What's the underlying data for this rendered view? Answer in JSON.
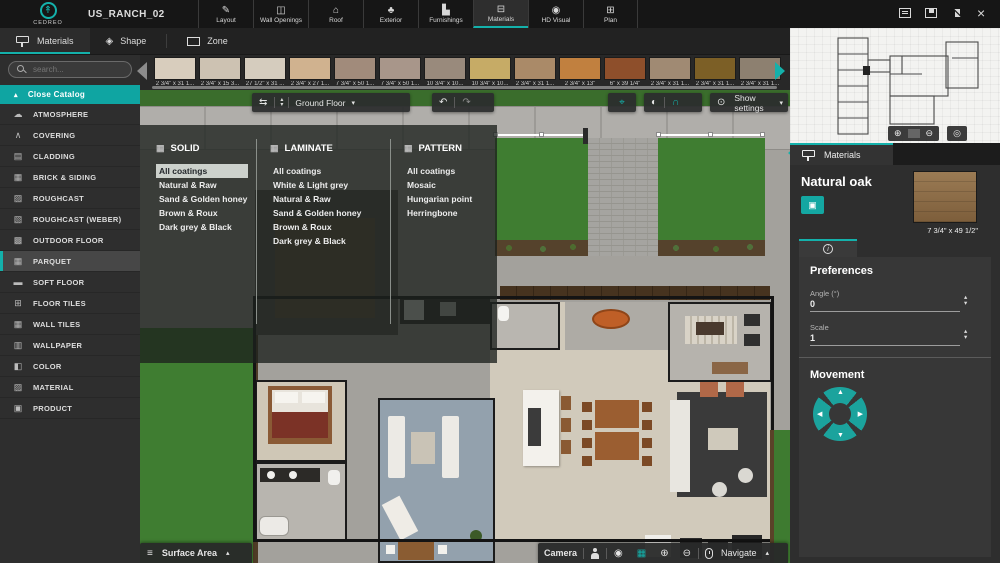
{
  "colors": {
    "accent": "#14b1ab",
    "teal_button": "#0fa5a2",
    "canvas_grass": "#3f7d31",
    "canvas_concrete": "#a3a19c"
  },
  "app": {
    "brand": "CEDREO",
    "project_title": "US_RANCH_02"
  },
  "window_controls": {
    "close": "×"
  },
  "top_tabs": [
    {
      "icon": "✎",
      "label": "Layout"
    },
    {
      "icon": "◫",
      "label": "Wall Openings"
    },
    {
      "icon": "⌂",
      "label": "Roof"
    },
    {
      "icon": "♣",
      "label": "Exterior"
    },
    {
      "icon": "▙",
      "label": "Furnishings"
    },
    {
      "icon": "⊟",
      "label": "Materials"
    },
    {
      "icon": "◉",
      "label": "HD Visual"
    },
    {
      "icon": "⊞",
      "label": "Plan"
    }
  ],
  "mode_tabs": [
    {
      "label": "Materials"
    },
    {
      "label": "Shape",
      "icon": "◈"
    },
    {
      "label": "Zone"
    }
  ],
  "sidebar": {
    "search_placeholder": "search...",
    "close_catalog": "Close Catalog",
    "items": [
      {
        "icon": "☁",
        "label": "ATMOSPHERE"
      },
      {
        "icon": "∧",
        "label": "COVERING"
      },
      {
        "icon": "▤",
        "label": "CLADDING"
      },
      {
        "icon": "▦",
        "label": "BRICK & SIDING"
      },
      {
        "icon": "▨",
        "label": "ROUGHCAST"
      },
      {
        "icon": "▧",
        "label": "ROUGHCAST (WEBER)"
      },
      {
        "icon": "▩",
        "label": "OUTDOOR FLOOR"
      },
      {
        "icon": "▦",
        "label": "PARQUET"
      },
      {
        "icon": "▬",
        "label": "SOFT FLOOR"
      },
      {
        "icon": "⊞",
        "label": "FLOOR TILES"
      },
      {
        "icon": "▦",
        "label": "WALL TILES"
      },
      {
        "icon": "▥",
        "label": "WALLPAPER"
      },
      {
        "icon": "◧",
        "label": "COLOR"
      },
      {
        "icon": "▨",
        "label": "MATERIAL"
      },
      {
        "icon": "▣",
        "label": "PRODUCT"
      }
    ]
  },
  "thumbnails": [
    {
      "label": "2 3/4\" x 31 1...",
      "color": "#d8cdbd"
    },
    {
      "label": "2 3/4\" x 15 3...",
      "color": "#cdc2b2"
    },
    {
      "label": "27 1/2\" x 31 ...",
      "color": "#d5ccbe"
    },
    {
      "label": "2 3/4\" x 27 1...",
      "color": "#d0b28f"
    },
    {
      "label": "7 3/4\" x 50 1...",
      "color": "#a18b7b"
    },
    {
      "label": "7 3/4\" x 50 1...",
      "color": "#a8968a"
    },
    {
      "label": "10 3/4\" x 10...",
      "color": "#998a7c"
    },
    {
      "label": "10 3/4\" x 10...",
      "color": "#c6ab66"
    },
    {
      "label": "2 3/4\" x 31 1...",
      "color": "#aa8a68"
    },
    {
      "label": "2 3/4\" x 13\"",
      "color": "#c1803f"
    },
    {
      "label": "6\" x 39 1/4\"",
      "color": "#8e4f2b"
    },
    {
      "label": "2 3/4\" x 31 1...",
      "color": "#a08a73"
    },
    {
      "label": "2 3/4\" x 31 1...",
      "color": "#7c5f26"
    },
    {
      "label": "2 3/4\" x 31 1...",
      "color": "#8d8070"
    }
  ],
  "canvas": {
    "floor_selector": "Ground Floor",
    "show_settings": "Show settings",
    "surface_area": "Surface Area",
    "camera": "Camera",
    "navigate": "Navigate"
  },
  "catalog_overlay": {
    "columns": [
      {
        "title": "SOLID",
        "items": [
          "All coatings",
          "Natural & Raw",
          "Sand & Golden honey",
          "Brown & Roux",
          "Dark grey & Black"
        ],
        "active_item": "All coatings"
      },
      {
        "title": "LAMINATE",
        "items": [
          "All coatings",
          "White & Light grey",
          "Natural & Raw",
          "Sand & Golden honey",
          "Brown & Roux",
          "Dark grey & Black"
        ]
      },
      {
        "title": "PATTERN",
        "items": [
          "All coatings",
          "Mosaic",
          "Hungarian point",
          "Herringbone"
        ]
      }
    ]
  },
  "right_panel": {
    "tab": "Materials",
    "material_name": "Natural oak",
    "thumb_caption": "7 3/4\" x 49 1/2\"",
    "apply_icon": "▣",
    "info_icon": "i",
    "preferences": {
      "heading": "Preferences",
      "angle_label": "Angle (°)",
      "angle_value": "0",
      "scale_label": "Scale",
      "scale_value": "1"
    },
    "movement_heading": "Movement"
  },
  "icons": {
    "sync": "⇆",
    "chevron_up": "▴",
    "chevron_down": "▾",
    "undo": "↶",
    "redo": "↷",
    "target": "⌖",
    "sphere": "◐",
    "arc": "∩",
    "eye": "⊙",
    "list": "≡",
    "zoom_in": "⊕",
    "zoom_out": "⊖",
    "compass": "◎",
    "orbit_cam": "◉",
    "plan_2d": "▦",
    "logo_tree": "↟",
    "tri_up": "▲",
    "tri_down": "▼",
    "tri_left": "◀",
    "tri_right": "▶",
    "search": "css-magnifier",
    "comment": "css-shape",
    "save": "css-shape",
    "collapse": "css-shape",
    "paint_roller": "css-shape",
    "mouse": "css-shape",
    "person": "css-shape",
    "zone_rect": "css-shape"
  }
}
